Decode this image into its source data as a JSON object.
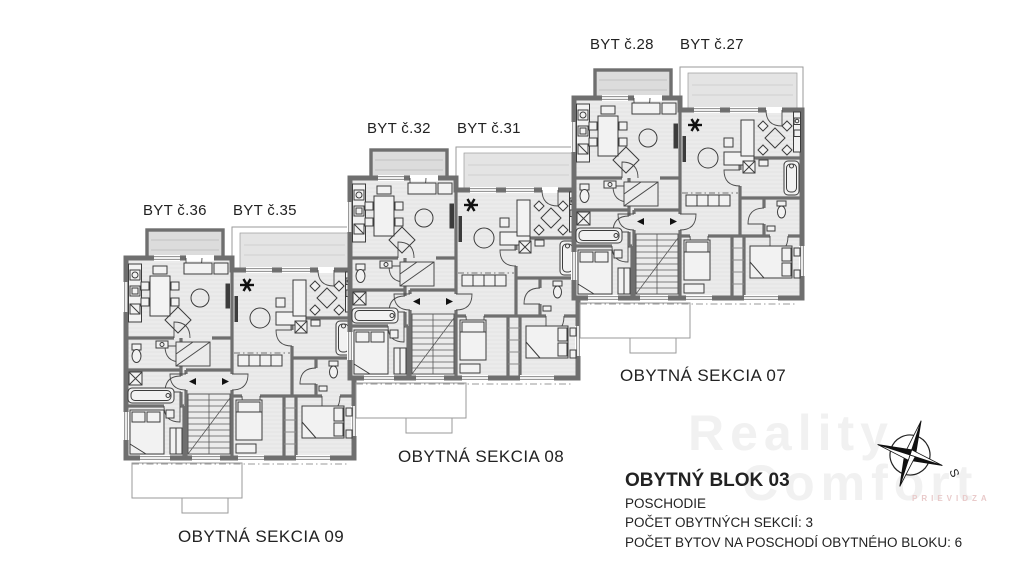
{
  "apartments": [
    {
      "id": "byt-36",
      "label": "BYT č.36"
    },
    {
      "id": "byt-35",
      "label": "BYT č.35"
    },
    {
      "id": "byt-32",
      "label": "BYT č.32"
    },
    {
      "id": "byt-31",
      "label": "BYT č.31"
    },
    {
      "id": "byt-28",
      "label": "BYT č.28"
    },
    {
      "id": "byt-27",
      "label": "BYT č.27"
    }
  ],
  "sections": [
    {
      "id": "07",
      "label": "OBYTNÁ SEKCIA 07"
    },
    {
      "id": "08",
      "label": "OBYTNÁ SEKCIA 08"
    },
    {
      "id": "09",
      "label": "OBYTNÁ SEKCIA 09"
    }
  ],
  "info": {
    "title": "OBYTNÝ BLOK 03",
    "line1": "POSCHODIE",
    "line2": "POČET OBYTNÝCH SEKCIÍ: 3",
    "line3": "POČET BYTOV NA POSCHODÍ OBYTNÉHO BLOKU: 6"
  },
  "compass": {
    "south_label": "S"
  },
  "watermark": {
    "line1": "Reality",
    "line2": "Comfort",
    "city": "PRIEVIDZA"
  },
  "colors": {
    "wall": "#6f6f6f",
    "floor": "#ebebeb",
    "balcony": "#dcdcdc",
    "furniture_line": "#3c3c3c",
    "text": "#222222",
    "watermark": "#f1f1f1"
  }
}
